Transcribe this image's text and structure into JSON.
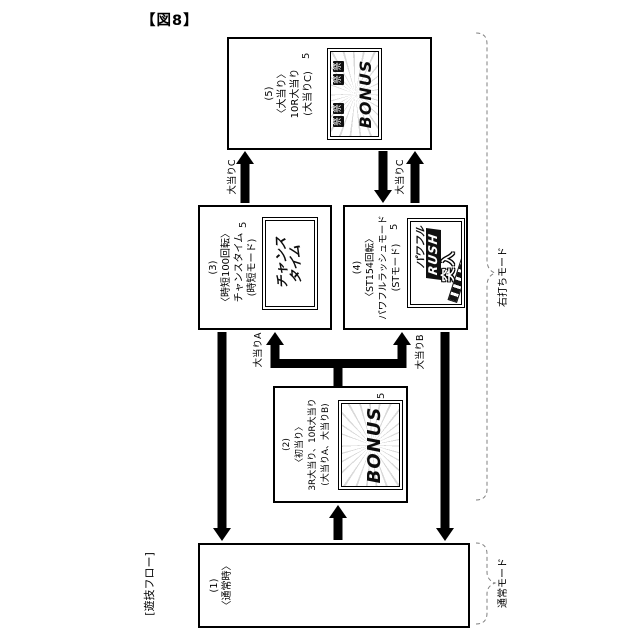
{
  "figure_label": "【図8】",
  "flow_label": "[遊技フロー]",
  "modes": {
    "right_hit": "右打ちモード",
    "normal": "通常モード"
  },
  "transitions": {
    "a": "大当りA",
    "b": "大当りB",
    "c_from_chance": "大当りC",
    "c_from_rush": "大当りC"
  },
  "line_color": "#000000",
  "brace_color": "#808080",
  "boxes": {
    "normal": {
      "lines": [
        "(1)",
        "〈通常時〉"
      ]
    },
    "first_hit": {
      "lines": [
        "(2)",
        "〈初当り〉",
        "3R大当り、10R大当り",
        "(大当りA、大当りB)"
      ],
      "screen": {
        "ref": "5",
        "title": "BONUS"
      }
    },
    "chance_time": {
      "lines": [
        "(3)",
        "〈時短100回転〉",
        "チャンスタイム",
        "(時短モード)"
      ],
      "screen": {
        "ref": "5",
        "line1": "チャンス",
        "line2": "タイム"
      }
    },
    "powerful_rush": {
      "lines": [
        "(4)",
        "〈ST154回転〉",
        "パワフルラッシュモード",
        "(STモード)"
      ],
      "screen": {
        "ref": "5",
        "word1": "パワフル",
        "word2": "RUSH",
        "word3": "突入"
      }
    },
    "jackpot": {
      "lines": [
        "(5)",
        "〈大当り〉",
        "10R大当り",
        "(大当りC)"
      ],
      "screen": {
        "ref": "5",
        "title": "BONUS",
        "deco": "祭"
      }
    }
  }
}
